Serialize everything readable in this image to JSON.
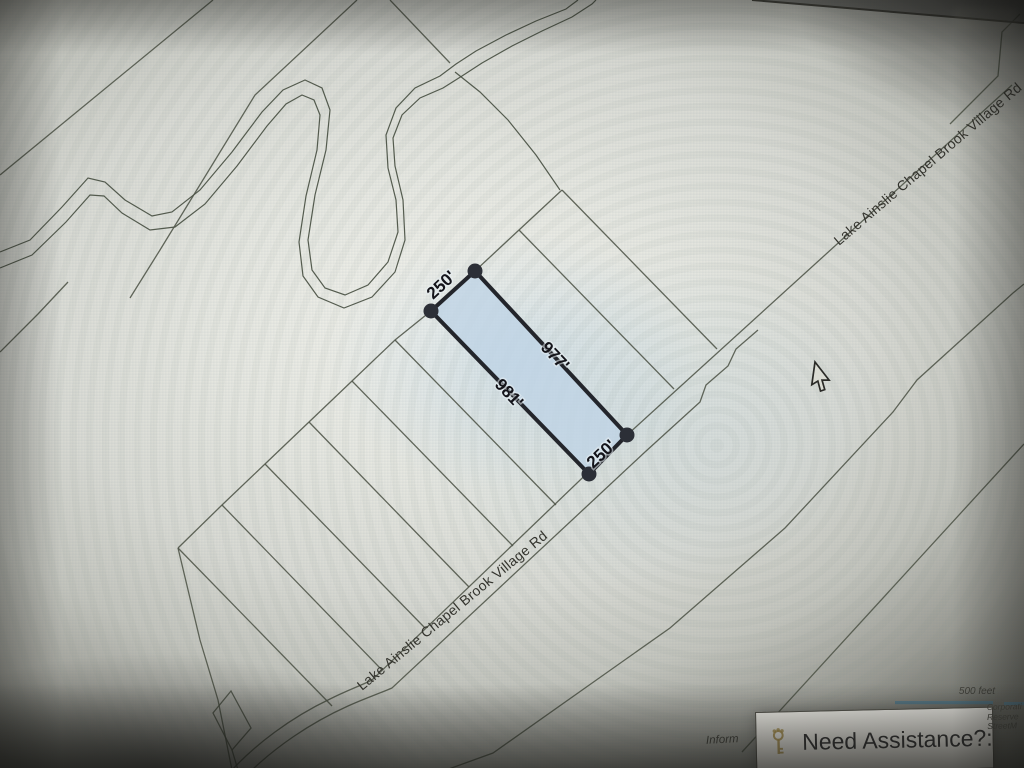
{
  "map": {
    "road_label": "Lake Ainslie Chapel Brook Village Rd",
    "parcel": {
      "dimensions": [
        "250'",
        "977'",
        "981'",
        "250'"
      ],
      "fill_color": "#bfd4e5",
      "outline_color": "#23252b"
    },
    "scale_bar": {
      "label": "500 feet",
      "color": "#5d7f8e"
    },
    "line_color": "#4d5347"
  },
  "help_box": {
    "title": "Need Assistance?:",
    "icon": "key-icon",
    "accent_color": "#ab9350"
  },
  "attribution": {
    "lines": [
      "Corporati",
      "Reserve",
      "StreetM"
    ],
    "partial_left": "Inform"
  }
}
